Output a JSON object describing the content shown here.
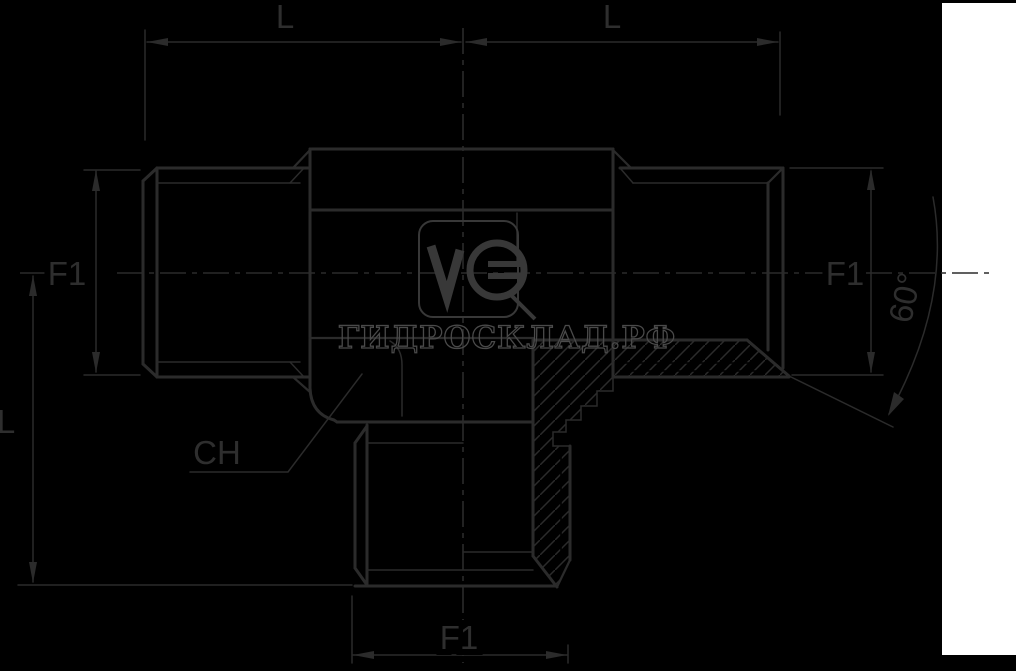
{
  "image": {
    "width": 1016,
    "height": 671,
    "background": "#000000",
    "side_panel_color": "#ffffff",
    "line_color": "#2b2b2b",
    "label_color": "#2e2e2e",
    "watermark_color": "#4a4a4a"
  },
  "drawing": {
    "title": "tee-fitting-technical-drawing",
    "dimensions": {
      "top_left_length": "L",
      "top_right_length": "L",
      "left_thread_size": "F1",
      "right_thread_size": "F1",
      "bottom_thread_size": "F1",
      "left_branch_length": "L",
      "hex_across_flats": "CH",
      "cone_angle": "60°"
    },
    "watermark": {
      "text": "ГИДРОСКЛАД.РФ",
      "logo_text": "VG"
    }
  }
}
